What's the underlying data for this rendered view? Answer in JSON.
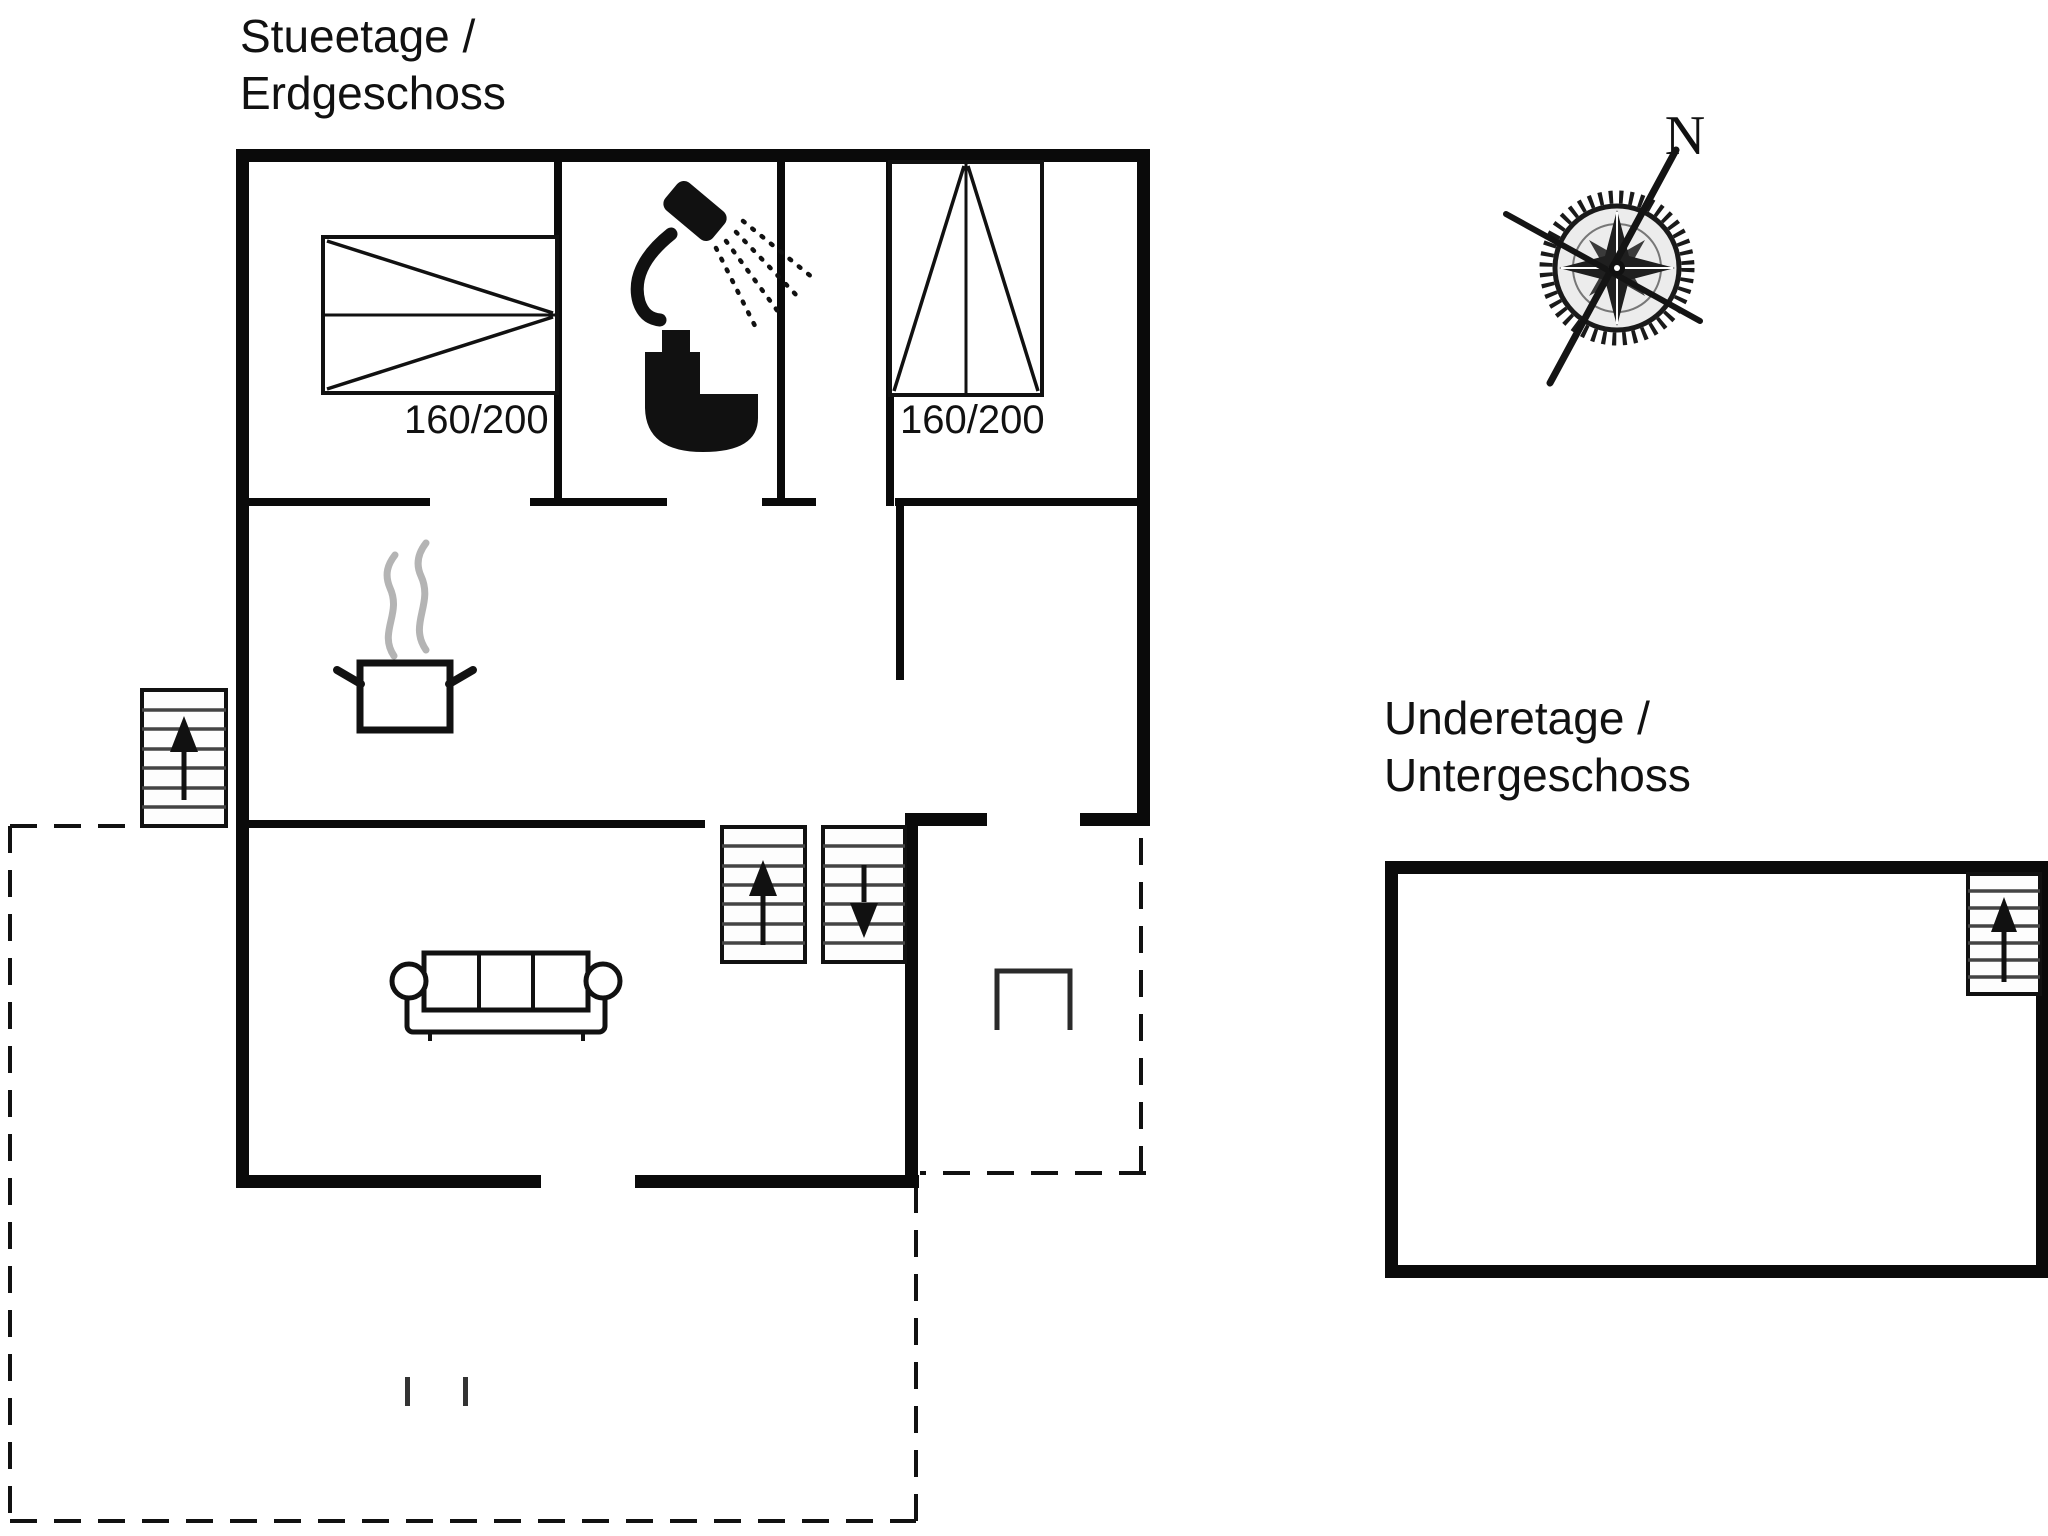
{
  "colors": {
    "wall": "#0a0a0a",
    "line": "#111111",
    "steam_gray": "#b4b4b4",
    "background": "#ffffff"
  },
  "ground_floor": {
    "title": {
      "line1": "Stueetage /",
      "line2": "Erdgeschoss"
    },
    "beds": [
      {
        "label": "160/200",
        "orientation": "horizontal"
      },
      {
        "label": "160/200",
        "orientation": "vertical"
      }
    ],
    "icons": [
      "double-bed-icon",
      "shower-icon",
      "toilet-icon",
      "stove-pot-icon",
      "steam-icon",
      "sofa-icon",
      "stairs-up-icon",
      "stairs-down-icon",
      "exterior-stairs-icon",
      "terrace-dashed-outline",
      "terrace-bench-icon"
    ]
  },
  "basement": {
    "title": {
      "line1": "Underetage /",
      "line2": "Untergeschoss"
    },
    "icons": [
      "stairs-up-icon"
    ]
  },
  "compass": {
    "label": "N"
  }
}
